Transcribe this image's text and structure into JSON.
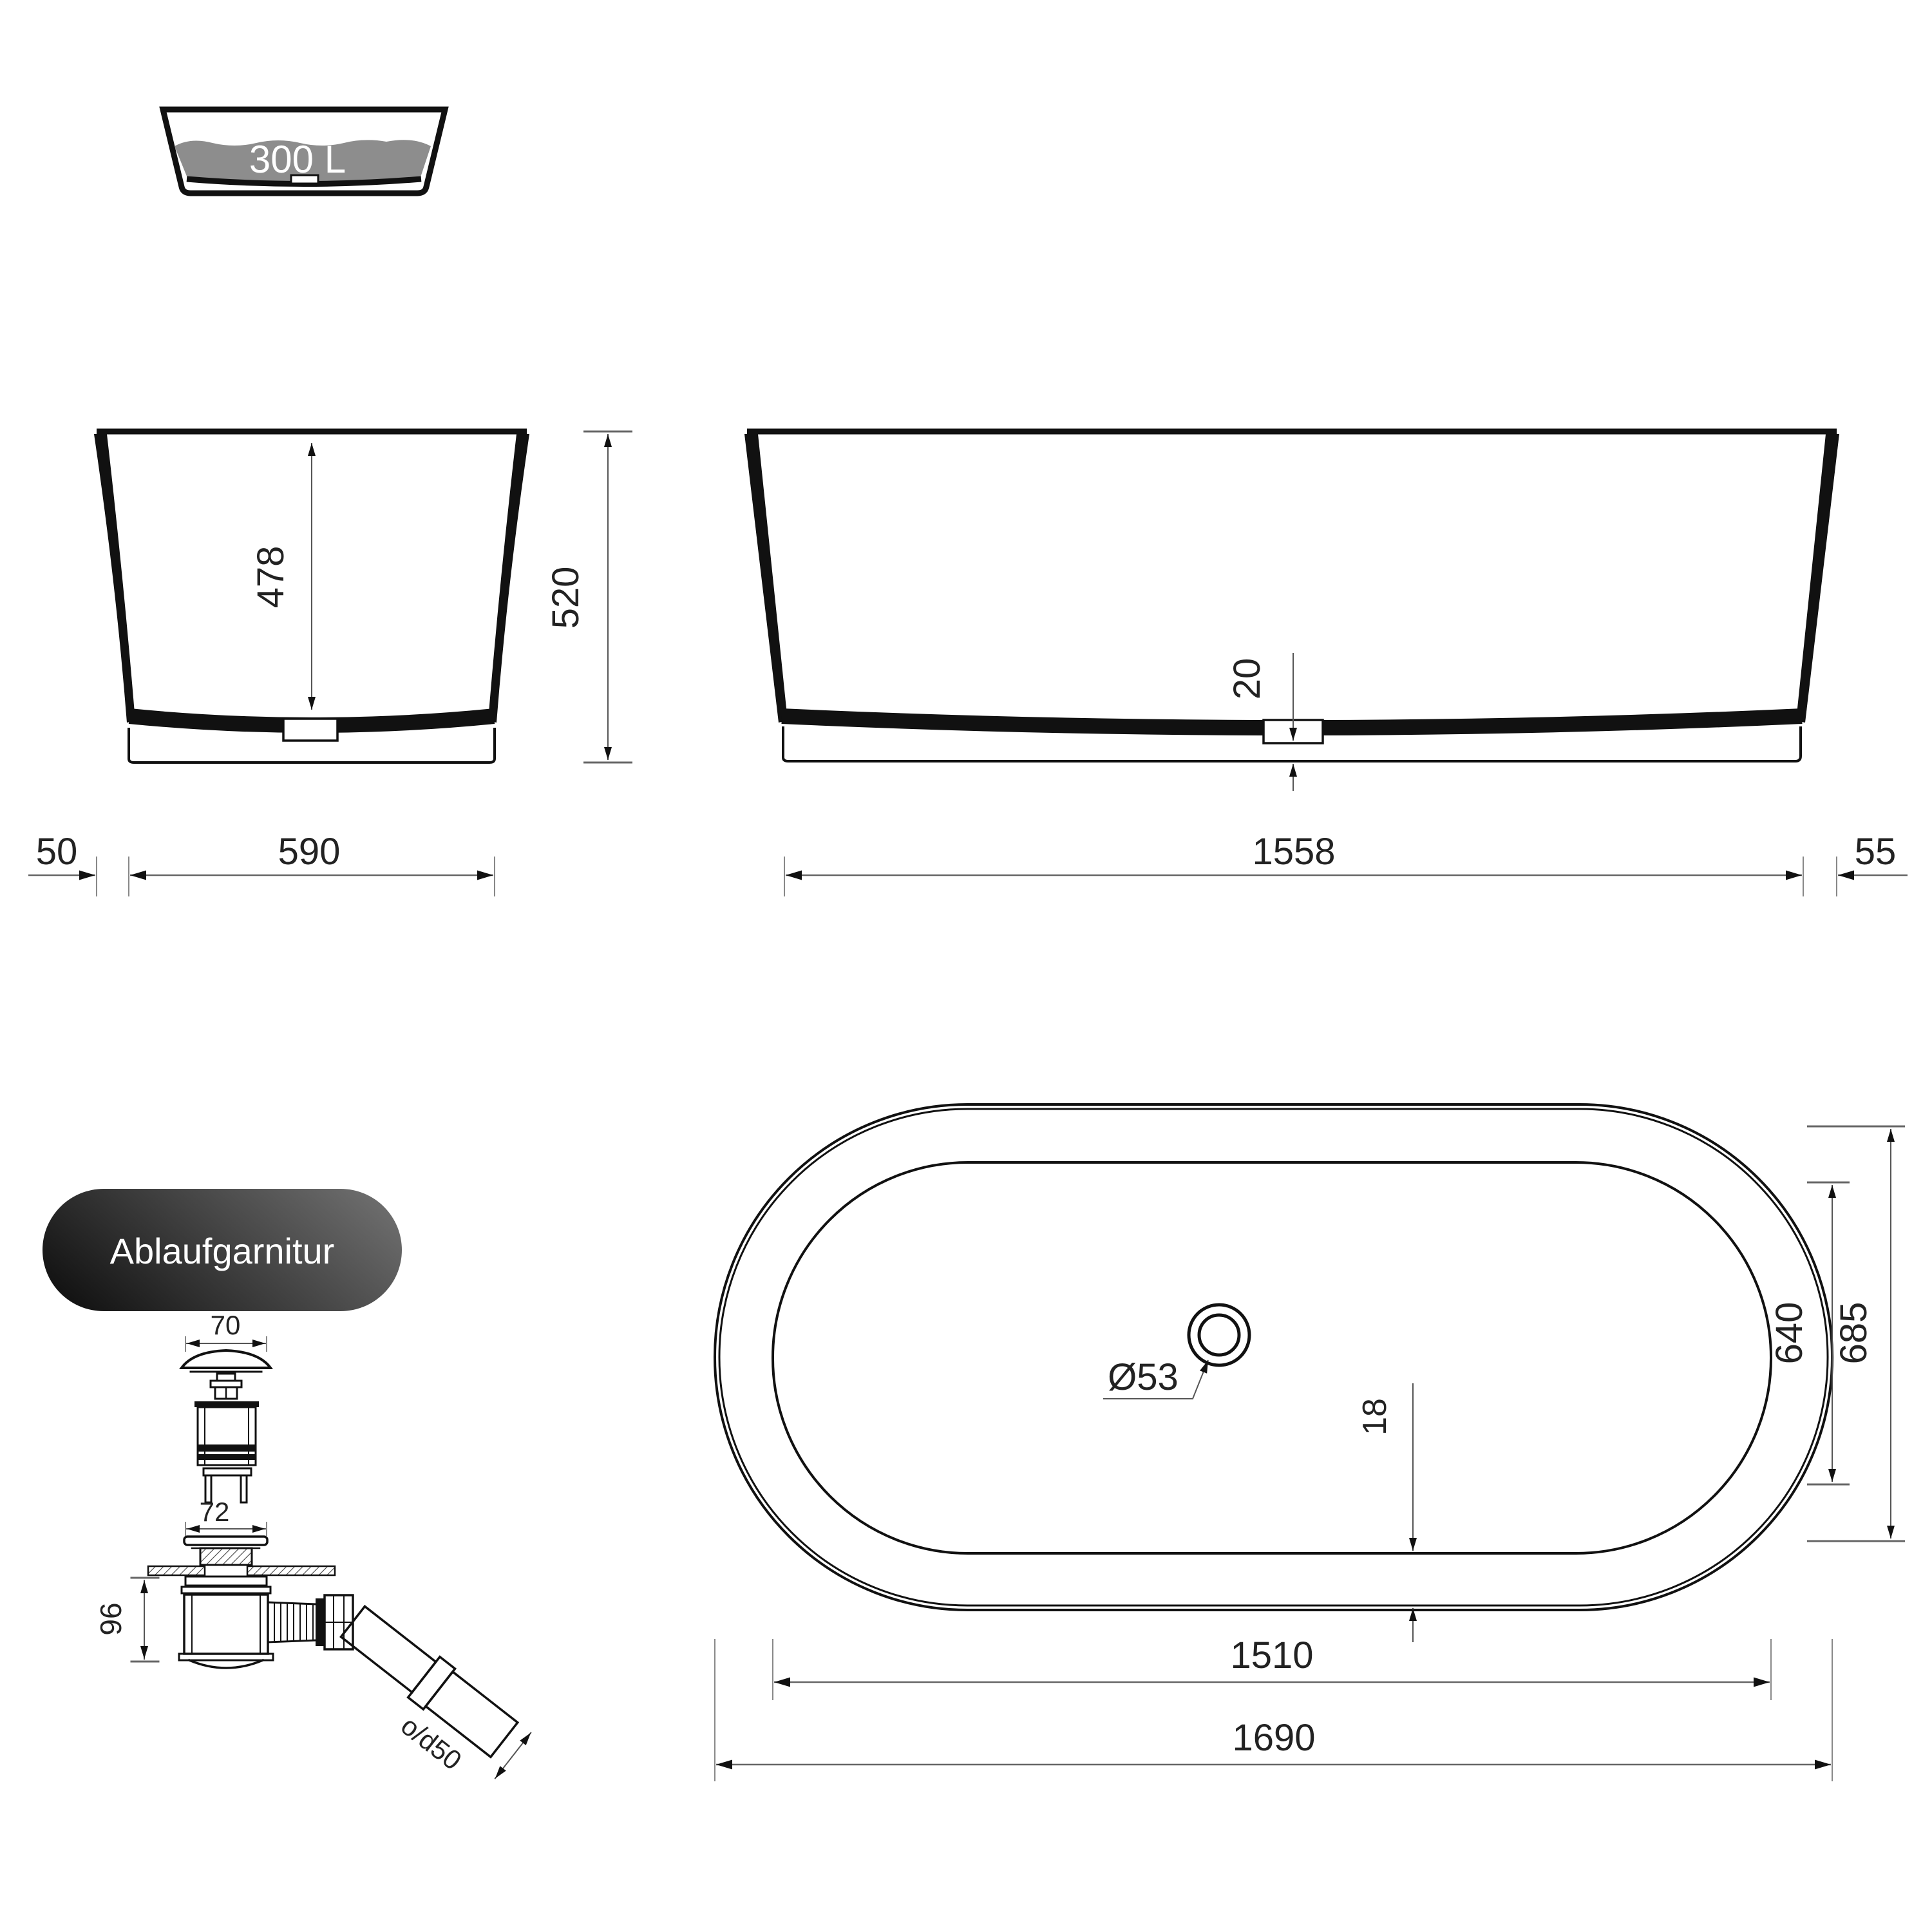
{
  "capacity": {
    "label": "300 L"
  },
  "drain_kit": {
    "label": "Ablaufgarnitur"
  },
  "dims": {
    "inner_depth": "478",
    "total_height": "520",
    "rim_overhang_left": "50",
    "base_width": "590",
    "bottom_thickness": "20",
    "base_length": "1558",
    "rim_overhang_right": "55",
    "plug_cap_width": "70",
    "flange_width": "72",
    "trap_height": "96",
    "outlet_pipe": "o/d50",
    "drain_diameter": "Ø53",
    "rim_inset": "18",
    "inner_width": "640",
    "outer_width": "685",
    "inner_length": "1510",
    "outer_length": "1690"
  },
  "colors": {
    "line": "#111111",
    "dimension_line": "#666666",
    "water_fill": "#8d8d8d",
    "pill_dark": "#141414",
    "pill_light": "#6b6b6b",
    "text": "#222222"
  }
}
